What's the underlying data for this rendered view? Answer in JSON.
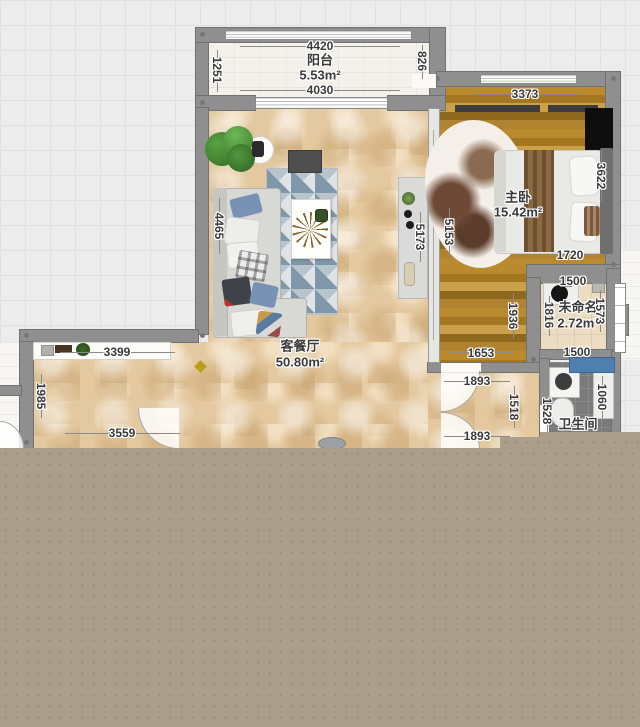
{
  "app": {
    "view": "floor-plan-canvas"
  },
  "rooms": [
    {
      "id": "balcony",
      "name": "阳台",
      "area": "5.53m²"
    },
    {
      "id": "bedroom",
      "name": "主卧",
      "area": "15.42m²"
    },
    {
      "id": "living",
      "name": "客餐厅",
      "area": "50.80m²"
    },
    {
      "id": "unnamed",
      "name": "未命名",
      "area": "2.72m²"
    },
    {
      "id": "bathroom",
      "name": "卫生间",
      "area": ""
    }
  ],
  "labels": {
    "balcony_top": "4420",
    "balcony_name": "阳台",
    "balcony_area": "5.53m²",
    "balcony_bottom": "4030",
    "balcony_left": "1251",
    "balcony_right": "826",
    "bedroom_top": "3373",
    "bedroom_name": "主卧",
    "bedroom_area": "15.42m²",
    "bedroom_right": "3622",
    "bedroom_left": "5153",
    "bedroom_bottom": "1720",
    "bedroom_leg_right": "1936",
    "bedroom_leg_bottom": "1653",
    "living_name": "客餐厅",
    "living_area": "50.80m²",
    "living_left": "4465",
    "living_right": "5173",
    "ext_top": "3399",
    "ext_left": "1985",
    "ext_bottom": "3559",
    "hall_top": "1893",
    "hall_bottom": "1893",
    "hall_right": "1518",
    "unnamed_top": "1500",
    "unnamed_name": "未命名",
    "unnamed_area": "2.72m²",
    "unnamed_left": "1816",
    "unnamed_right": "1573",
    "unnamed_bottom": "1500",
    "bath_name": "卫生间",
    "bath_left": "1528",
    "bath_right": "1060"
  },
  "colors": {
    "wall": "#8f8f8f",
    "background_grid": "#ececec",
    "floor_marble": "#e4c9a0",
    "floor_wood": "#b0872f",
    "floor_bath": "#7a7a7a",
    "bottom_panel": "#ab9e8a",
    "bathtub_blue": "#4f7fae",
    "plant_green": "#3f7d2c",
    "rug_blue": "#7e98a9"
  }
}
